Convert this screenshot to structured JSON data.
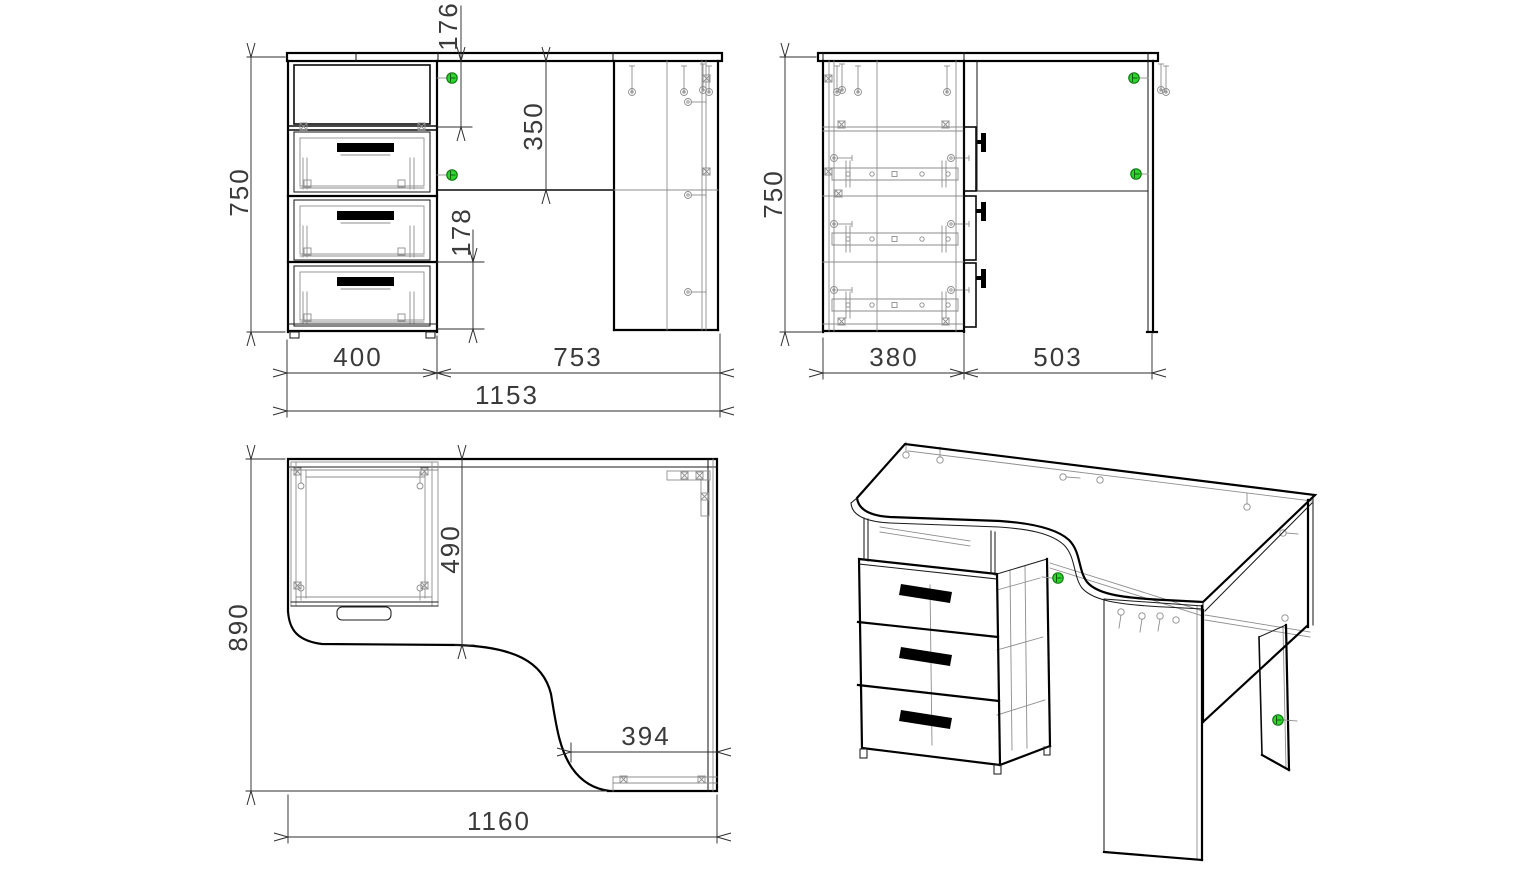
{
  "drawing": {
    "type": "furniture technical drawing - corner computer desk with drawer unit",
    "views": {
      "front": {
        "label": "front-view",
        "dims": {
          "height": "750",
          "opening_height": "176",
          "top_to_rail": "350",
          "drawer_pitch": "178",
          "cabinet_width": "400",
          "right_span": "753",
          "total_width": "1153"
        }
      },
      "side": {
        "label": "side-view",
        "dims": {
          "height": "750",
          "cabinet_depth": "380",
          "open_depth": "503"
        }
      },
      "plan": {
        "label": "plan-view",
        "dims": {
          "depth": "890",
          "cutout_depth": "490",
          "front_edge_segment": "394",
          "total_width": "1160"
        }
      },
      "iso": {
        "label": "isometric-view"
      }
    },
    "colors": {
      "outline": "#000000",
      "hardware": "#8d8d8d",
      "dimension": "#2e2e2e",
      "dimension_text": "#3a3a3a",
      "cam_indicator": "#2fd42f",
      "handle": "#000000",
      "background": "#ffffff"
    },
    "icons": {
      "cam_indicator": "green circular cam-lock fastener marker",
      "screw": "circle head with shaft line",
      "cam_housing": "small square with X"
    }
  }
}
